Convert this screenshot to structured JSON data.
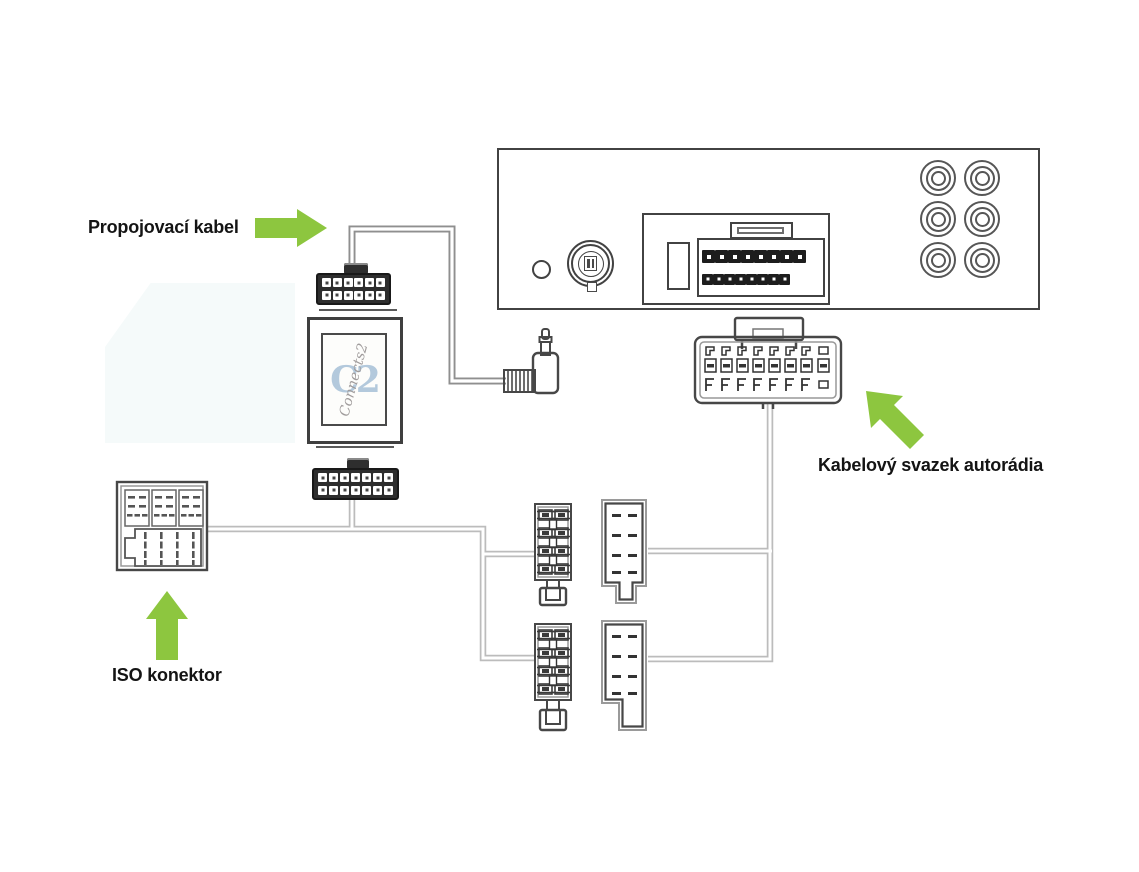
{
  "labels": {
    "interconnect_cable": "Propojovací kabel",
    "radio_harness": "Kabelový svazek autorádia",
    "iso_connector": "ISO konektor"
  },
  "logo": {
    "monogram": "C2",
    "script": "Connects2"
  },
  "colors": {
    "arrow_green": "#8dc63f",
    "outline_dark": "#424242",
    "outline_mid": "#6e6e6e",
    "wire_gray": "#bcbcbc",
    "cable_gray": "#8f8f8f",
    "connector_black": "#2e2e2e",
    "logo_blue": "#b3c9dc",
    "logo_script": "#a09c9c",
    "watermark": "#f5fafa"
  },
  "radio": {
    "rca_jacks": {
      "rows": 3,
      "cols": 2
    },
    "main_connector_pins": {
      "rows": 2,
      "cols": 8
    }
  },
  "adapter": {
    "top_connector_pins": {
      "rows": 2,
      "cols": 6
    },
    "bottom_connector_pins": {
      "rows": 2,
      "cols": 7
    }
  },
  "harness_connector": {
    "terminal_columns": 8,
    "terminal_rows": 3
  }
}
